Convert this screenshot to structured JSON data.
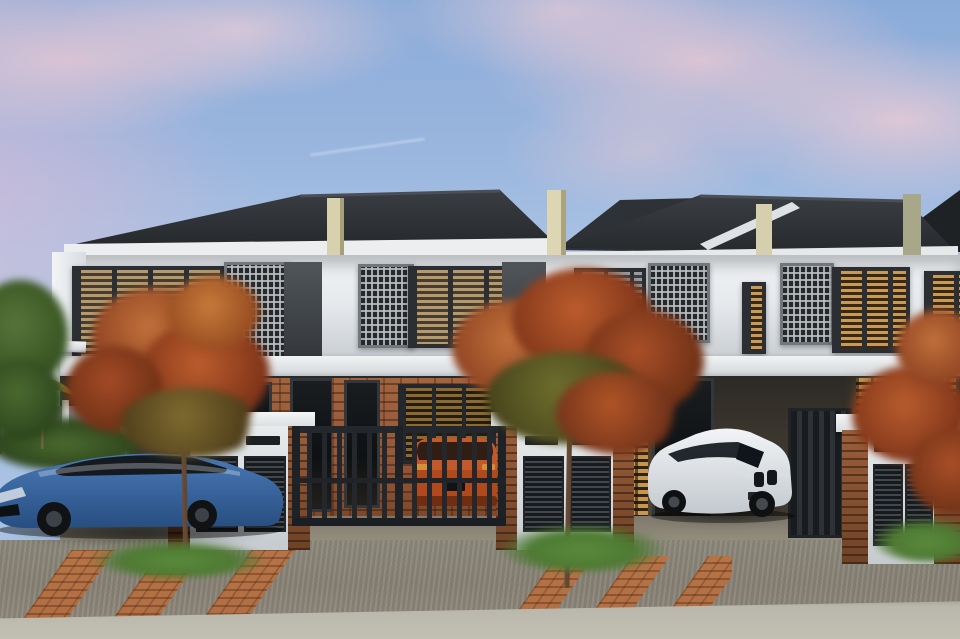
{
  "scene": {
    "description": "Photorealistic dusk rendering of a row of modern double-storey terrace houses with parked cars, flame-orange street trees and a brick-paved driveway",
    "time_of_day": "dusk",
    "sky": {
      "palette": [
        "pastel blue",
        "pink clouds",
        "lavender wash at left"
      ]
    },
    "houses": {
      "visible_units": 4,
      "storeys": 2,
      "roof": "dark pitched tile roofs",
      "facade": "white render with cream divider fins",
      "upper_floor_features": [
        "perforated breeze-block screens",
        "dark-framed timber louvre windows",
        "warm-lit amber louvres"
      ],
      "ground_floor_features": [
        "brick accent walls",
        "dark glass doors",
        "lit timber slat screens",
        "metal driveway gates",
        "brick-and-white gate piers with louvred meter panels"
      ]
    },
    "cars": [
      {
        "name": "blue-sedan",
        "body_color": "#30609f",
        "location": "left carport"
      },
      {
        "name": "olive-hatchback",
        "body_color": "#63603f",
        "plate": "WA 787 A",
        "location": "left carport, beside sedan"
      },
      {
        "name": "orange-suv",
        "body_color": "#b04a1c",
        "location": "parked behind centre gate"
      },
      {
        "name": "white-coupe",
        "body_color": "#e8ebee",
        "location": "right carport"
      }
    ],
    "vegetation": [
      "two flame-orange street trees",
      "green tree at far left",
      "hedge behind boundary fence",
      "grass tufts along driveway edges"
    ],
    "street": {
      "surface": "broom-finished concrete driveway",
      "accents": "diagonal clay-brick paver bands",
      "foreground": "light concrete curb strip"
    },
    "props": [
      "olive garden umbrella",
      "grey boundary fence with white posts"
    ]
  },
  "colors": {
    "sky-top": "#8aabd9",
    "sky-mid": "#a9c2e3",
    "cloud-pink": "#ecc9d2",
    "roof-dark": "#26292c",
    "roof-lit": "#3a3e43",
    "fascia": "#eceef0",
    "facade": "#e7eaed",
    "facade-shade": "#c9ced3",
    "fin-cream": "#d8d1ae",
    "frame-dark": "#2b2f33",
    "slat-tan": "#b49a6c",
    "slat-amber": "#c99a55",
    "slat-grey": "#979da2",
    "breeze-dark": "#26292c",
    "brick": "#95593a",
    "timber-lit": "#c8964e",
    "gate-metal": "#24272b",
    "road": "#898376",
    "paver": "#b26a3c",
    "curb": "#b9b7ab",
    "grass": "#4e7a33",
    "foliage-orange": "#bb5c2d",
    "trunk": "#5d4330",
    "sedan-blue": "#30609f",
    "mini-olive": "#63603f",
    "suv-orange": "#b04a1c",
    "coupe-white": "#e8ebee",
    "umbrella-olive": "#b3a14a"
  }
}
